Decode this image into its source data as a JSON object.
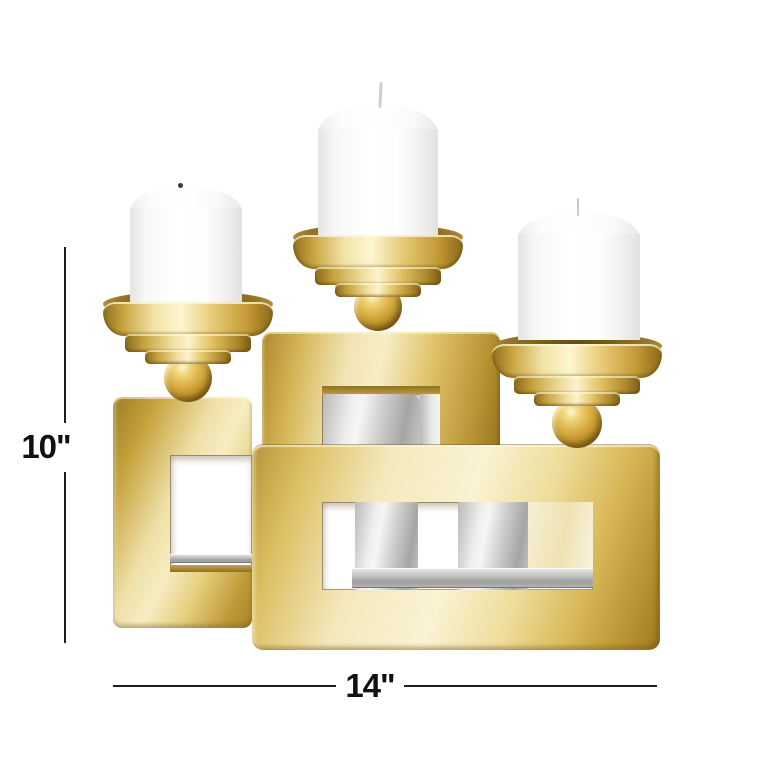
{
  "meta": {
    "type": "product-dimension-image",
    "background_color": "#ffffff"
  },
  "product": {
    "name": "gold three-pillar candle holder",
    "candle_count": 3,
    "visible_parts": [
      "white pillar candles",
      "gold flared candle cups",
      "gold ball stems",
      "interlocking rectangular gold frames",
      "silver inner frame"
    ]
  },
  "annotations": {
    "height_label": "10\"",
    "width_label": "14\"",
    "line_color": "#1d1d1b",
    "label_color": "#111111"
  },
  "palette": {
    "gold_highlight": "#f7eec6",
    "gold_mid": "#d5b455",
    "gold_deep": "#97741f",
    "silver_highlight": "#efefed",
    "silver_mid": "#c6c6c4",
    "silver_deep": "#9f9f9d",
    "candle_white": "#ffffff",
    "candle_shadow": "#e6e6e4",
    "wick_dark": "#3a3a38"
  }
}
